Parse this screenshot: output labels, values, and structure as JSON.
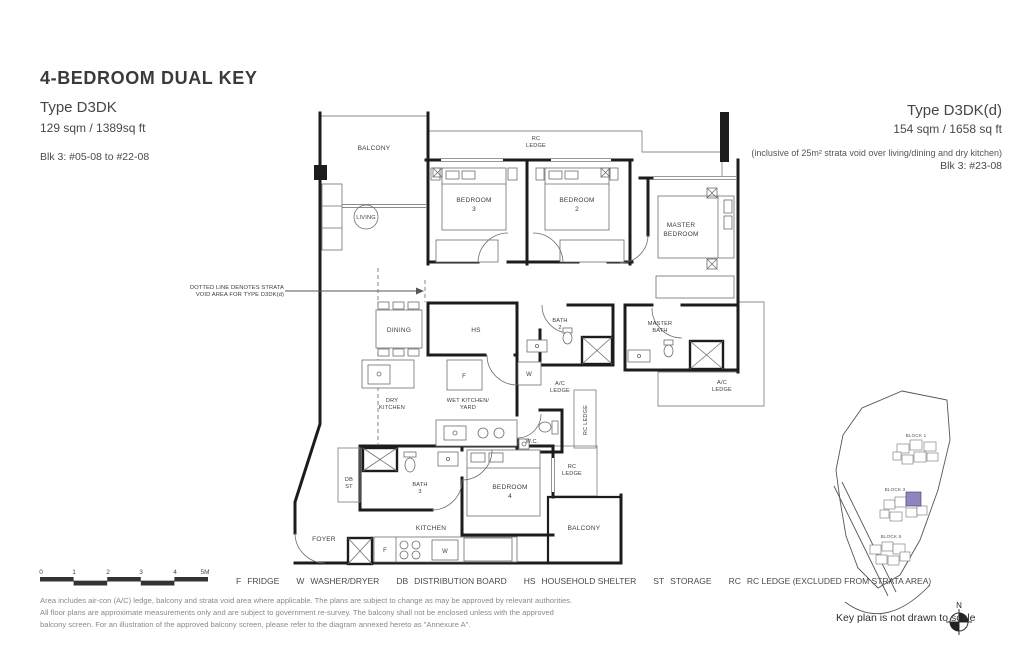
{
  "header": {
    "title": "4-BEDROOM DUAL KEY",
    "left": {
      "type_name": "Type D3DK",
      "area": "129 sqm / 1389sq ft",
      "block": "Blk 3: #05-08 to #22-08"
    },
    "right": {
      "type_name": "Type D3DK(d)",
      "area": "154 sqm / 1658 sq ft",
      "note": "(inclusive of 25m² strata void over living/dining and dry kitchen)",
      "block": "Blk 3: #23-08"
    }
  },
  "plan": {
    "labels": {
      "balcony_top": "BALCONY",
      "rc_ledge_top": [
        "RC",
        "LEDGE"
      ],
      "living": "LIVING",
      "bedroom3": [
        "BEDROOM",
        "3"
      ],
      "bedroom2": [
        "BEDROOM",
        "2"
      ],
      "master_bedroom": [
        "MASTER",
        "BEDROOM"
      ],
      "dining": "DINING",
      "hs": "HS",
      "bath2": [
        "BATH",
        "2"
      ],
      "master_bath": [
        "MASTER",
        "BATH"
      ],
      "ac_ledge_mid": [
        "A/C",
        "LEDGE"
      ],
      "ac_ledge_right": [
        "A/C",
        "LEDGE"
      ],
      "rc_ledge_mid": "RC LEDGE",
      "dry_kitchen": [
        "DRY",
        "KITCHEN"
      ],
      "wet_kitchen": [
        "WET KITCHEN/",
        "YARD"
      ],
      "wc": "W.C.",
      "db_st": [
        "DB",
        "ST"
      ],
      "bath3": [
        "BATH",
        "3"
      ],
      "bedroom4": [
        "BEDROOM",
        "4"
      ],
      "rc_ledge_lower": [
        "RC",
        "LEDGE"
      ],
      "balcony_bottom": "BALCONY",
      "kitchen": "KITCHEN",
      "foyer": "FOYER",
      "fridge_abbr": "F",
      "washer_abbr": "W"
    },
    "annotation": [
      "DOTTED LINE DENOTES STRATA",
      "VOID AREA FOR TYPE D3DK(d)"
    ]
  },
  "scalebar": {
    "ticks": [
      "0",
      "1",
      "2",
      "3",
      "4",
      "5M"
    ]
  },
  "legend": {
    "items": [
      {
        "abbr": "F",
        "label": "FRIDGE"
      },
      {
        "abbr": "W",
        "label": "WASHER/DRYER"
      },
      {
        "abbr": "DB",
        "label": "DISTRIBUTION BOARD"
      },
      {
        "abbr": "HS",
        "label": "HOUSEHOLD SHELTER"
      },
      {
        "abbr": "ST",
        "label": "STORAGE"
      },
      {
        "abbr": "RC",
        "label": "RC LEDGE (EXCLUDED FROM STRATA AREA)"
      }
    ]
  },
  "disclaimer": [
    "Area includes air-con (A/C) ledge, balcony and strata void area where applicable. The plans are subject to change as may be approved by relevant authorities.",
    "All floor plans are approximate measurements only and are subject to government re-survey. The balcony shall not be enclosed unless with the approved",
    "balcony screen. For an illustration of the approved balcony screen, please refer to the diagram annexed hereto as \"Annexure A\"."
  ],
  "keyplan": {
    "block1": "BLOCK 1",
    "block3": "BLOCK 3",
    "block5": "BLOCK 5",
    "north_label": "N",
    "note": "Key plan is not drawn to scale",
    "highlight_color": "#9184bd"
  }
}
